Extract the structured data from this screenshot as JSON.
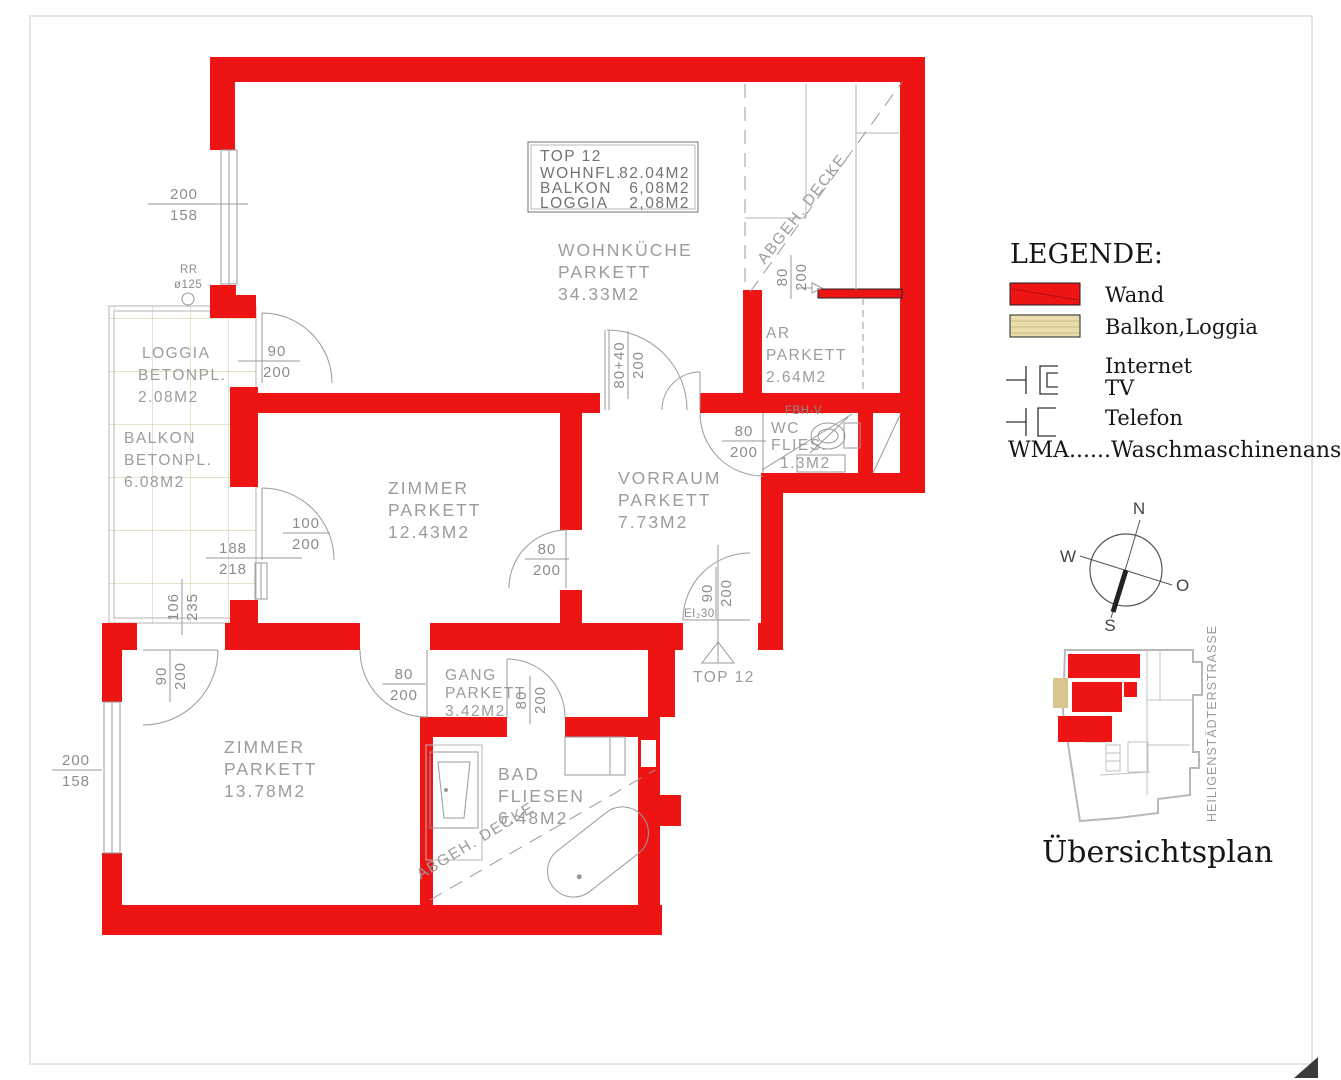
{
  "colors": {
    "wall_red": "#ee1414",
    "balkon_fill": "#e9ddab",
    "balkon_line": "#cdbc80",
    "drawing_line": "#9a9a9a",
    "room_text": "#9c9c9c",
    "legend_text": "#161616"
  },
  "title_block": {
    "title": "TOP 12",
    "rows": [
      {
        "label": "WOHNFL.",
        "value": "82.04M2"
      },
      {
        "label": "BALKON",
        "value": "6,08M2"
      },
      {
        "label": "LOGGIA",
        "value": "2,08M2"
      }
    ]
  },
  "rooms": {
    "wohnkueche": {
      "l1": "WOHNKÜCHE",
      "l2": "PARKETT",
      "l3": "34.33M2"
    },
    "ar": {
      "l1": "AR",
      "l2": "PARKETT",
      "l3": "2.64M2"
    },
    "wc": {
      "l1": "WC",
      "l2": "FLIES.",
      "l3": "1.3M2"
    },
    "vorraum": {
      "l1": "VORRAUM",
      "l2": "PARKETT",
      "l3": "7.73M2"
    },
    "zimmer1": {
      "l1": "ZIMMER",
      "l2": "PARKETT",
      "l3": "12.43M2"
    },
    "zimmer2": {
      "l1": "ZIMMER",
      "l2": "PARKETT",
      "l3": "13.78M2"
    },
    "gang": {
      "l1": "GANG",
      "l2": "PARKETT",
      "l3": "3.42M2"
    },
    "bad": {
      "l1": "BAD",
      "l2": "FLIESEN",
      "l3": "6.48M2"
    },
    "loggia": {
      "l1": "LOGGIA",
      "l2": "BETONPL.",
      "l3": "2.08M2"
    },
    "balkon": {
      "l1": "BALKON",
      "l2": "BETONPL.",
      "l3": "6.08M2"
    }
  },
  "dims": {
    "win_top": {
      "a": "200",
      "b": "158"
    },
    "loggia_door": {
      "a": "90",
      "b": "200"
    },
    "balkon_door": {
      "a": "100",
      "b": "200"
    },
    "balkon_w": {
      "a": "188",
      "b": "218"
    },
    "balkon_h": {
      "a": "106",
      "b": "235"
    },
    "win_left": {
      "a": "200",
      "b": "158"
    },
    "zimmer2_door": {
      "a": "90",
      "b": "200"
    },
    "zimmer1_door": {
      "a": "80",
      "b": "200"
    },
    "double_door": {
      "a": "80+40",
      "b": "200"
    },
    "kitchen_pass": {
      "a": "80",
      "b": "200"
    },
    "wc_door": {
      "a": "80",
      "b": "200"
    },
    "gang_door": {
      "a": "80",
      "b": "200"
    },
    "bad_door": {
      "a": "80",
      "b": "200"
    },
    "entry_door": {
      "a": "90",
      "b": "200"
    }
  },
  "labels": {
    "rr": "RR",
    "rr_diameter": "ø125",
    "fbhv": "FBH-V.",
    "abgeh_decke": "ABGEH. DECKE",
    "entry_rating": "EI₂30",
    "entry_top": "TOP 12"
  },
  "legend": {
    "title": "LEGENDE:",
    "wand": "Wand",
    "balkon_loggia": "Balkon,Loggia",
    "internet": "Internet",
    "tv": "TV",
    "telefon": "Telefon",
    "wma": "WMA......Waschmaschinenanschlu"
  },
  "compass": {
    "n": "N",
    "s": "S",
    "w": "W",
    "o": "O"
  },
  "overview": {
    "caption": "Übersichtsplan",
    "street": "HEILIGENSTÄDTERSTRASSE"
  }
}
